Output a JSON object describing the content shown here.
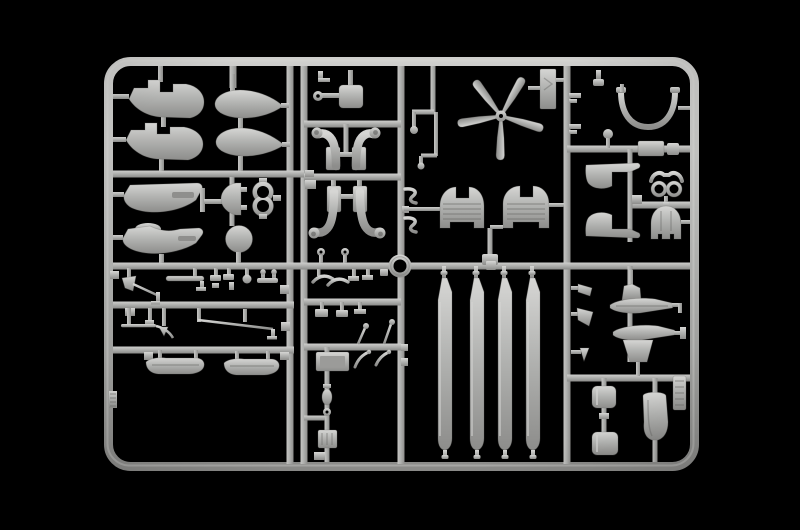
{
  "scene": {
    "description": "Photograph of a light gray injection-molded plastic model kit sprue (parts frame) of helicopter components on a pure black background",
    "background": "black",
    "object": "model-kit-sprue"
  },
  "colors": {
    "background": "#000000",
    "plastic_base": "#b3b4b2",
    "plastic_highlight": "#d6d6d4",
    "plastic_mid": "#a9a9a7",
    "plastic_shadow": "#8d8d8b",
    "plastic_deep": "#6a6a68"
  },
  "sprue": {
    "material_look": "light gray polystyrene, glossy",
    "frame": "rounded rectangle runner frame with two full-height double rails and internal cross rails forming part cells",
    "center_ring_junction": "open circular ring where the center horizontal rail meets the center vertical rail",
    "inventory": [
      {
        "name": "fuselage-side-panel",
        "count": 2,
        "cell": "top-left"
      },
      {
        "name": "drop-tank-half",
        "count": 2,
        "cell": "top-left"
      },
      {
        "name": "cowl-panel",
        "count": 2,
        "cell": "mid-left"
      },
      {
        "name": "half-drum-shell",
        "count": 1,
        "cell": "mid-left"
      },
      {
        "name": "twin-ring-part",
        "count": 1,
        "cell": "mid-left"
      },
      {
        "name": "disc-wheel",
        "count": 1,
        "cell": "mid-left"
      },
      {
        "name": "mirror-plate",
        "count": 1,
        "cell": "top-middle"
      },
      {
        "name": "exhaust-pipe-pair",
        "count": 2,
        "cell": "top-middle"
      },
      {
        "name": "tail-rotor-5-blade",
        "count": 1,
        "cell": "top-center"
      },
      {
        "name": "chevron-panel",
        "count": 1,
        "cell": "top-center"
      },
      {
        "name": "cockpit-bulkhead-arch",
        "count": 2,
        "cell": "top-center"
      },
      {
        "name": "canopy-bow",
        "count": 1,
        "cell": "top-right"
      },
      {
        "name": "cowl-wedge",
        "count": 2,
        "cell": "right"
      },
      {
        "name": "goggle-shaped-sight",
        "count": 1,
        "cell": "right"
      },
      {
        "name": "cowling-dome",
        "count": 1,
        "cell": "right"
      },
      {
        "name": "hull-float-half",
        "count": 2,
        "cell": "bottom-right"
      },
      {
        "name": "seat-back",
        "count": 2,
        "cell": "bottom-right"
      },
      {
        "name": "bucket-seat",
        "count": 1,
        "cell": "bottom-right"
      },
      {
        "name": "ribbed-id-tag",
        "count": 1,
        "cell": "bottom-right-frame-edge"
      },
      {
        "name": "main-rotor-blade",
        "count": 4,
        "cell": "bottom-center"
      },
      {
        "name": "landing-skid",
        "count": 2,
        "cell": "bottom-left"
      },
      {
        "name": "pitot-mast",
        "count": 1,
        "cell": "bottom-left"
      },
      {
        "name": "linkage-rod",
        "count": 3,
        "cell": "bottom-left"
      },
      {
        "name": "instrument-box",
        "count": 1,
        "cell": "bottom-middle"
      },
      {
        "name": "small-fittings",
        "count_approx": 30,
        "cell": "various"
      }
    ],
    "counts": {
      "main_rotor_blades": 4,
      "tail_rotor_blades": 5,
      "drop_tanks": 2,
      "skids": 2
    }
  }
}
